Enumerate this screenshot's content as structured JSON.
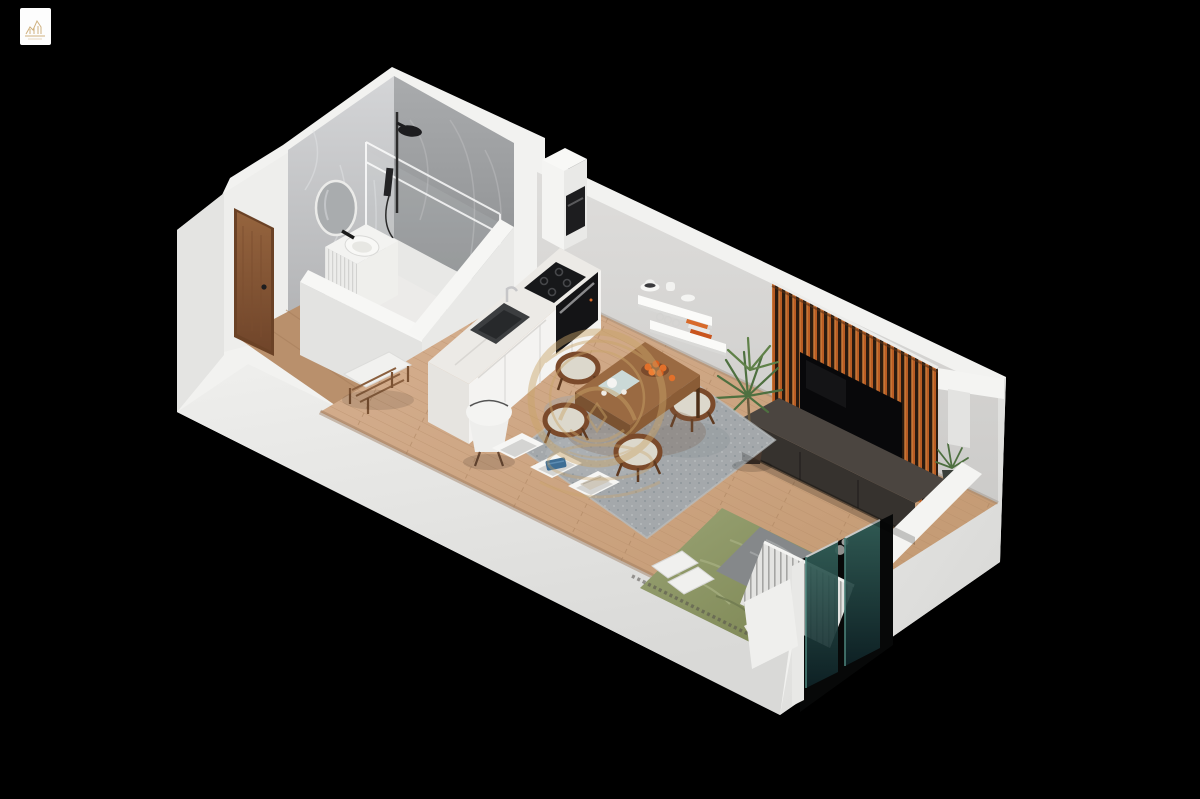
{
  "meta": {
    "kind": "isometric-3d-floorplan-render",
    "width": 1200,
    "height": 799,
    "background": "#000000"
  },
  "branding": {
    "corner_logo": {
      "present": true,
      "bg_color": "#fdfdfd",
      "glyph": "gold-skyline-sketch",
      "glyph_color": "#c8a46a"
    },
    "center_watermark": {
      "shape": "circular-gold-monogram-emblem",
      "color": "#c9a468",
      "opacity": 0.45
    }
  },
  "palette": {
    "background": "#000000",
    "wall_white": "#f2f2f0",
    "wall_face_sw": "#e4e4e2",
    "wall_face_interior": "#eeeeec",
    "wall_gray_ne": "#d8d8d6",
    "marble_light": "#cfd0d2",
    "marble_dark": "#9b9da0",
    "bath_floor": "#ecebe9",
    "floor_wood": "#d0a988",
    "entry_wood": "#b9906c",
    "door_wood": "#8a5637",
    "slat_orange": "#b85c24",
    "slat_dark": "#2a1b10",
    "tv_black": "#08080a",
    "console_brown": "#4b4540",
    "rug_gray": "#a4a8ab",
    "table_wood": "#9a6a42",
    "chair_wood": "#7b4a2b",
    "cushion": "#dcd8cc",
    "bed_green": "#8e9868",
    "throw_gray": "#85888a",
    "pillow_white": "#f0f0ee",
    "radiator_white": "#e3e3e1",
    "glass_teal": "#2e5a54",
    "plant_green": "#4e7040",
    "gold": "#c9a468"
  },
  "rooms": [
    {
      "name": "bathroom",
      "features": [
        "walk-in shower",
        "round mirror",
        "ribbed vanity basin",
        "glass enclosure",
        "marble walls",
        "shower tray drain"
      ]
    },
    {
      "name": "entry",
      "features": [
        "wood entry door",
        "slat bench with cushion"
      ]
    },
    {
      "name": "kitchen",
      "features": [
        "tall cabinet with built-in appliance",
        "induction cooktop",
        "built-in oven",
        "sink with faucet",
        "marble counter",
        "wall shelves with dishes"
      ]
    },
    {
      "name": "living-dining",
      "features": [
        "wood dining table",
        "four chairs",
        "fruit bowl",
        "area rug",
        "wood slat tv wall",
        "wall tv",
        "media console",
        "tall floor plant",
        "small corner plant",
        "white shell chair",
        "storage cubbies"
      ]
    },
    {
      "name": "sleeping",
      "features": [
        "double bed with green duvet",
        "gray throw",
        "white pillows",
        "slatted radiator",
        "corner glass window"
      ]
    }
  ]
}
